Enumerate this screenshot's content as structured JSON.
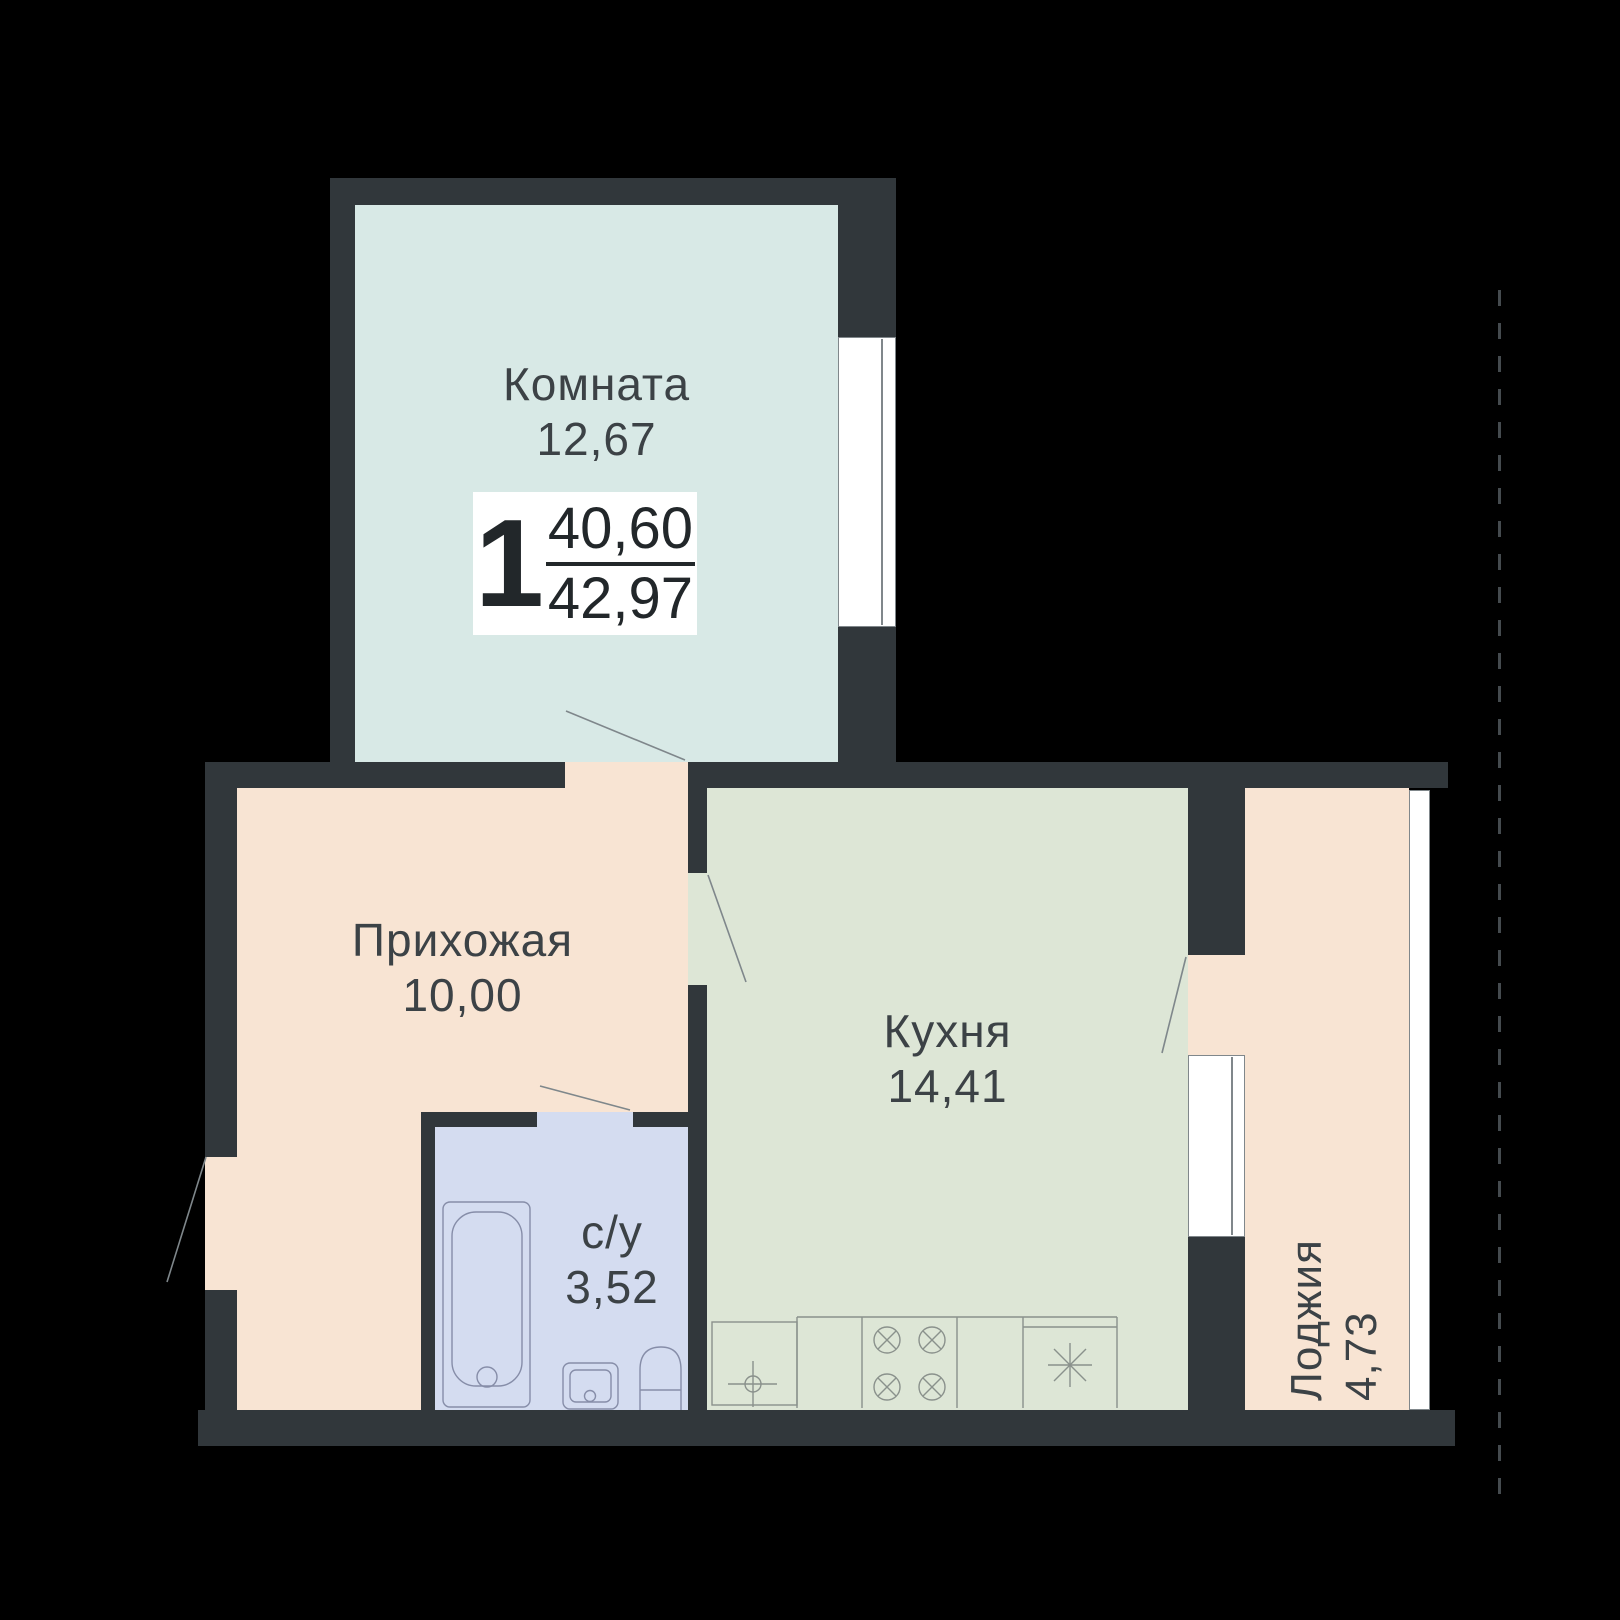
{
  "plan_title": "apartment-floor-plan",
  "badge": {
    "rooms_count": "1",
    "living_area": "40,60",
    "total_area": "42,97"
  },
  "rooms": {
    "living": {
      "label": "Комната",
      "area": "12,67"
    },
    "hallway": {
      "label": "Прихожая",
      "area": "10,00"
    },
    "kitchen": {
      "label": "Кухня",
      "area": "14,41"
    },
    "bathroom": {
      "label": "с/у",
      "area": "3,52"
    },
    "loggia": {
      "label": "Лоджия",
      "area": "4,73"
    }
  },
  "fixtures": [
    "bathtub-icon",
    "bath-sink-icon",
    "toilet-icon",
    "kitchen-sink-icon",
    "stove-4-burner-icon",
    "fridge-icon"
  ],
  "colors": {
    "background": "#000000",
    "wall": "#31373b",
    "living_fill": "#d8e9e6",
    "hallway_fill": "#f8e4d3",
    "kitchen_fill": "#dde6d6",
    "bathroom_fill": "#d4dcf0",
    "loggia_fill": "#f8e4d3",
    "window_fill": "#ffffff",
    "line_gray": "#80878b",
    "text": "#3c4246"
  }
}
